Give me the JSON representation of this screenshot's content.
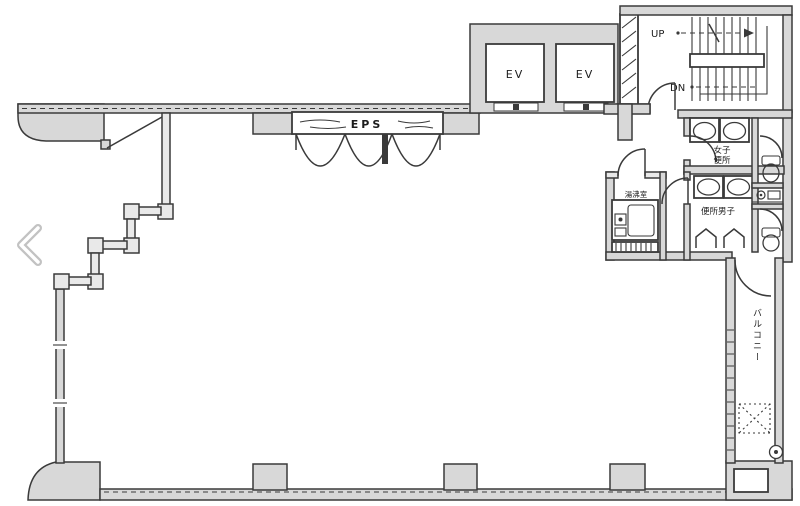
{
  "colors": {
    "background": "#ffffff",
    "wall_fill": "#d8d8d8",
    "line": "#3a3a3a",
    "chevron": "#c2c2c2"
  },
  "floor_plan": {
    "eps_label": "EPS",
    "elevators": [
      {
        "label": "EV"
      },
      {
        "label": "EV"
      }
    ],
    "stairs": {
      "up_label": "UP",
      "down_label": "DN"
    },
    "rooms": {
      "womens_toilet": {
        "label_line1": "女子",
        "label_line2": "便所"
      },
      "mens_toilet": {
        "label": "便所男子"
      },
      "kitchenette": {
        "label": "湯沸室"
      },
      "balcony": {
        "label": "バルコニー"
      }
    }
  },
  "carousel": {
    "prev_button_icon": "chevron-left"
  }
}
